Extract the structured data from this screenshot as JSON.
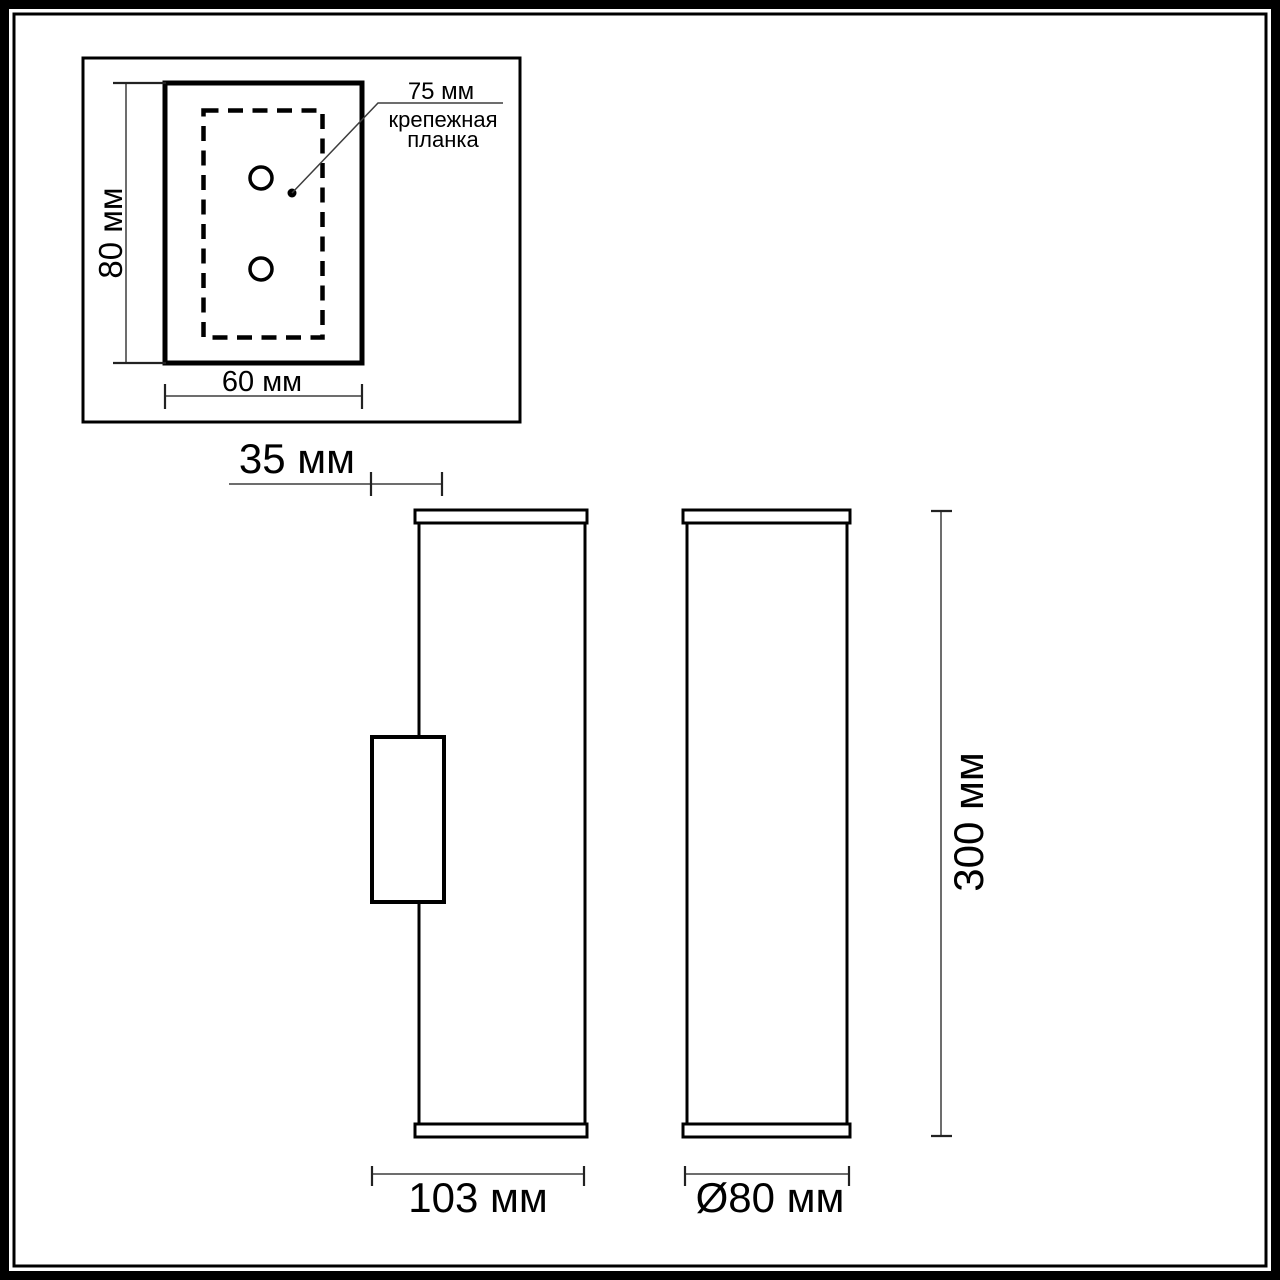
{
  "colors": {
    "background": "#ffffff",
    "ink": "#000000",
    "dimension_line": "#3d3d3d"
  },
  "inset": {
    "plate_height_label": "80 мм",
    "plate_width_label": "60 мм",
    "bracket_size_label": "75 мм",
    "bracket_name_line1": "крепежная",
    "bracket_name_line2": "планка"
  },
  "side_view": {
    "bracket_depth_label": "35 мм",
    "total_depth_label": "103 мм"
  },
  "front_view": {
    "height_label": "300 мм",
    "diameter_label": "Ø80 мм"
  }
}
